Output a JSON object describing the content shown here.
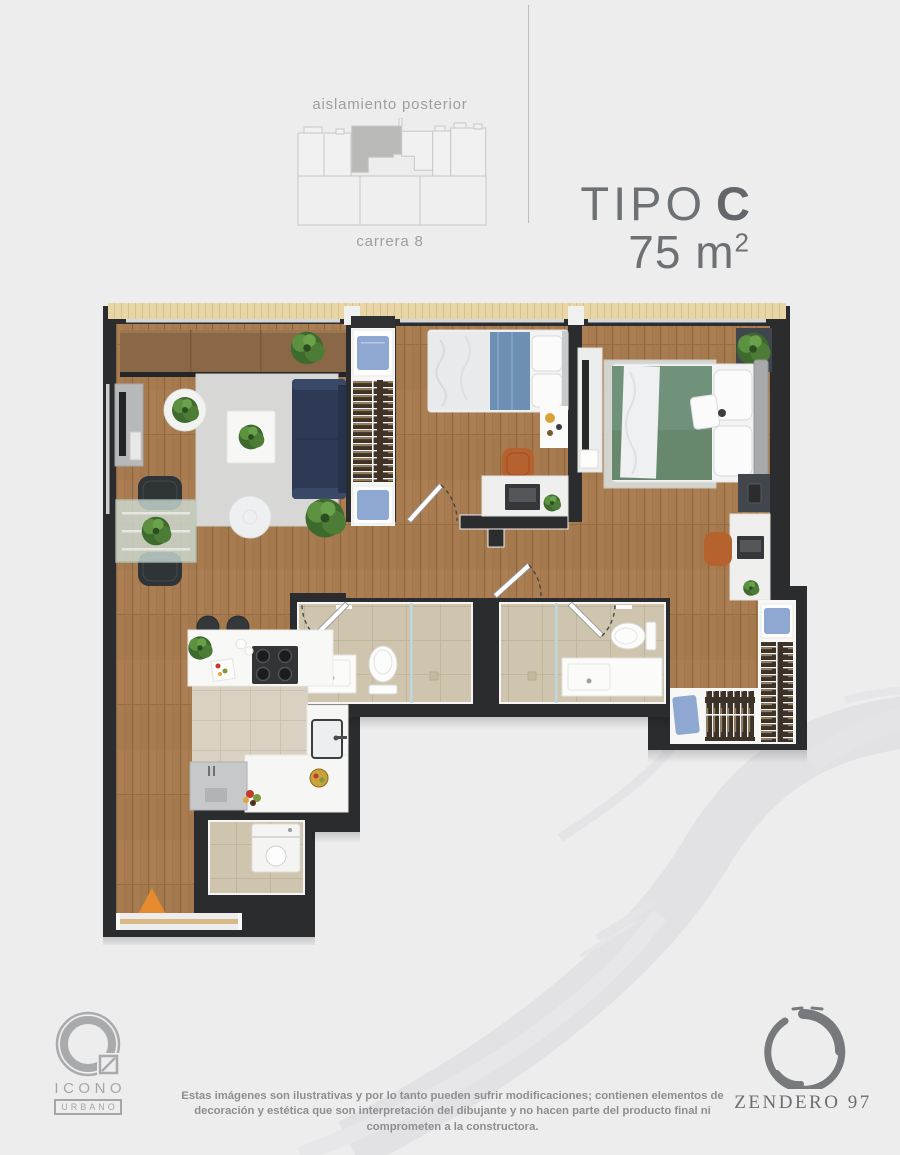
{
  "header": {
    "site_diagram": {
      "top_label": "aislamiento posterior",
      "bottom_label": "carrera 8",
      "highlight_color": "#b9bab8",
      "outline_color": "#c6c8c7"
    },
    "title": {
      "type_label": "TIPO",
      "type_value": "C",
      "area_value": "75 m",
      "area_exponent": "2"
    }
  },
  "plan": {
    "rooms": [
      "living-dining",
      "bedroom-1",
      "master-bedroom",
      "bathroom-1",
      "bathroom-2",
      "hallway",
      "kitchen",
      "laundry",
      "entry-corridor",
      "walk-in-closet"
    ],
    "furniture": [
      "sofa",
      "rug",
      "coffee-table",
      "tv-unit",
      "dining-table",
      "dining-chairs",
      "single-bed",
      "double-bed",
      "nightstands",
      "desks",
      "office-chairs",
      "wardrobes",
      "toilets",
      "vanities",
      "showers",
      "kitchen-island",
      "cooktop",
      "sink",
      "fridge",
      "bar-stools",
      "washing-machine",
      "plants"
    ],
    "entry_marker": "orange-triangle"
  },
  "theme": {
    "bg": "#ededee",
    "wall": "#2b2c2e",
    "wood": "#a87c50",
    "wood-strip": "#e9d6a6",
    "tile": "#cfc5ae",
    "tile-kitchen": "#d9d1c1",
    "rug": "#d7d7d5",
    "sofa-navy": "#2e3a55",
    "bed-green": "#70917a",
    "blanket-blue": "#6e8fb4",
    "shirt-blue": "#8fa8d2",
    "chair-brown": "#b5622e",
    "accent": "#e58a2f",
    "text-gray": "#6e7174",
    "label-gray": "#9c9fa0",
    "logo-gray": "#a4a6a8",
    "zen-gray": "#77797c",
    "disclaimer": "#8c8e90",
    "watermark": "#e2e2e4"
  },
  "footer": {
    "disclaimer": "Estas imágenes son ilustrativas y por lo tanto pueden sufrir modificaciones; contienen elementos de decoración y estética que son interpretación del dibujante y no hacen parte del producto final ni comprometen a la constructora.",
    "icono_logo": {
      "line1": "ICONO",
      "line2": "URBANO"
    },
    "zendero_logo": {
      "label": "ZENDERO 97"
    }
  }
}
